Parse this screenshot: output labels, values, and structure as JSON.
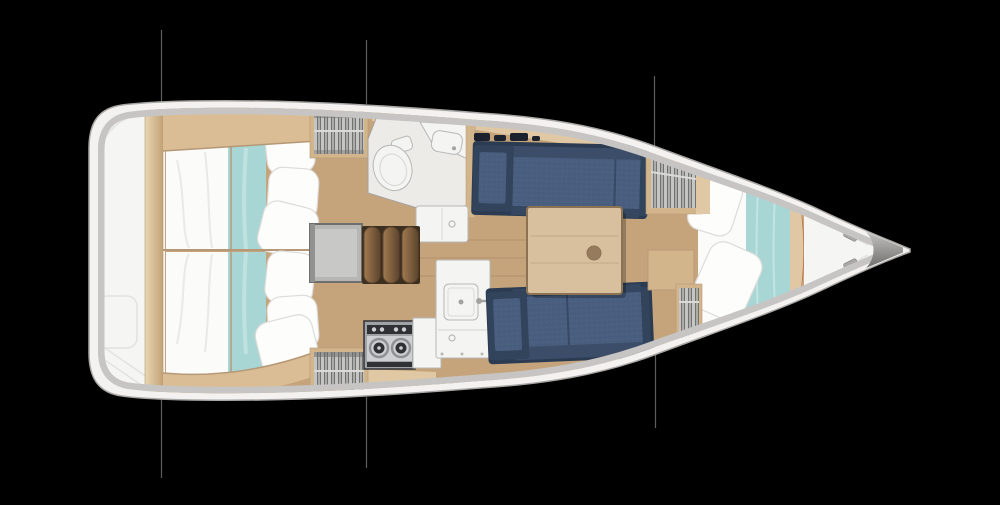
{
  "scene": {
    "type": "yacht-interior-floor-plan",
    "canvas": {
      "width": 1000,
      "height": 505
    },
    "orientation": "bow-right",
    "section_lines": {
      "above_hull": 3,
      "below_hull": 3
    },
    "areas": [
      {
        "id": "stern-garage",
        "label": "stern transom / storage"
      },
      {
        "id": "aft-cabin-upper",
        "label": "aft double cabin (upper)"
      },
      {
        "id": "aft-cabin-lower",
        "label": "aft double cabin (lower)"
      },
      {
        "id": "hanging-locker-aft-upper",
        "label": "hanging locker"
      },
      {
        "id": "hanging-locker-aft-lower",
        "label": "hanging locker"
      },
      {
        "id": "head-compartment",
        "label": "head with toilet and vanity"
      },
      {
        "id": "companionway",
        "label": "companionway steps and hatch"
      },
      {
        "id": "galley",
        "label": "galley with 2-burner stove and sink"
      },
      {
        "id": "settee-upper",
        "label": "saloon settee"
      },
      {
        "id": "settee-lower",
        "label": "saloon settee"
      },
      {
        "id": "saloon-table",
        "label": "saloon table"
      },
      {
        "id": "hanging-locker-forward",
        "label": "hanging locker"
      },
      {
        "id": "v-berth",
        "label": "forward V-berth cabin"
      },
      {
        "id": "foredeck",
        "label": "foredeck / anchor area"
      }
    ],
    "palette": {
      "bg": "#000000",
      "hullWhite": "#f3f2f0",
      "hullStroke": "#a8a7a5",
      "rimGray": "#c7c5c3",
      "sternWhite": "#f5f5f3",
      "sternLine": "#e2e2e0",
      "floorWood": "#c5a47c",
      "floorSeam": "rgba(92,64,35,0.18)",
      "lightWood": "#e0c8a4",
      "midWood": "#d3b58c",
      "beamWood": "#dabd95",
      "woodEdge": "#b59875",
      "postLight": "#e9d6b4",
      "postDark": "#c2a276",
      "duvetWhite": "#fbfbf9",
      "foldGray": "#e9e9e7",
      "teal": "#a7d6d5",
      "tealLight": "#c9e7e6",
      "tealSeam": "#c07a50",
      "pillowWhite": "#fdfdfc",
      "pillowStroke": "#dcdbd9",
      "lockerGray": "#919190",
      "clothesA": "#c9c9c8",
      "clothesB": "#6f6f6e",
      "clothesC": "#aeaead",
      "railGray": "#dadad9",
      "navyDark": "#2b3b52",
      "navyMid": "#3b4d68",
      "navySeat": "#4a5f7f",
      "navySeatHi": "#596f92",
      "navySeatLo": "#3d5170",
      "navyLip": "#354760",
      "navyArm": "#32435c",
      "shelfItem": "#1b222e",
      "tableWood": "#d8bf9d",
      "tableEdge": "#8a7253",
      "tableKnob": "#967b5c",
      "stepDark": "#5e452e",
      "stepLight": "#a07a50",
      "stepBg": "#3c2f1f",
      "hatchGray": "#b6b6b4",
      "hatchFrame": "#6e6e6c",
      "hatchInner": "#c8c8c6",
      "fixtureWhite": "#f4f4f2",
      "fixtureStroke": "#b7b7b5",
      "headFloor": "#ecebe8",
      "headWall": "#a3a2a0",
      "steelLight": "#cdcfd2",
      "steelMid": "#9fa2a6",
      "steelDark": "#2f3134",
      "burnerRing": "#8e9194",
      "bowLight": "#c2c1bf",
      "bowDark": "#6f6e6c",
      "cleatGray": "#a9a8a6",
      "sectionLine": "#6f6f6f",
      "shadow": "rgba(0,0,0,0.25)"
    }
  }
}
